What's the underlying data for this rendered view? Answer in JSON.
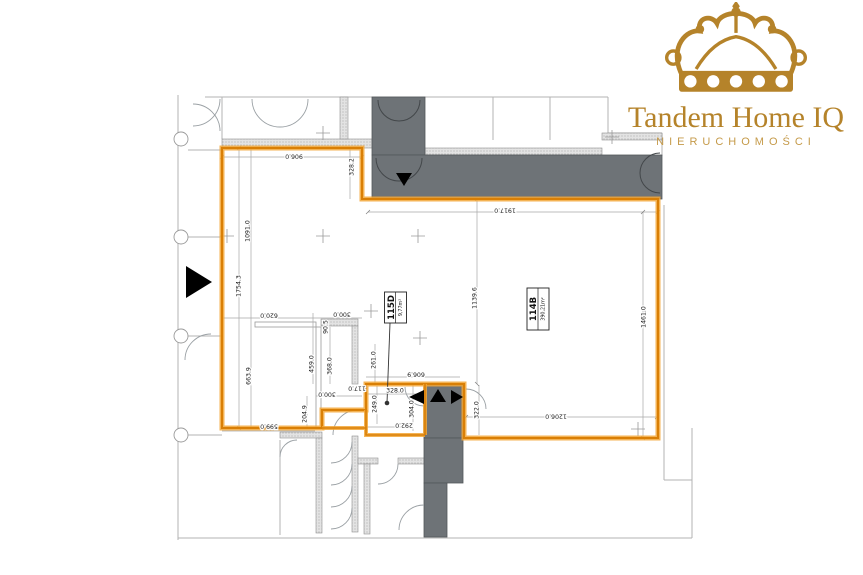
{
  "brand": {
    "name": "Tandem Home IQ",
    "subtitle": "NIERUCHOMOŚCI",
    "gold": "#b5832a"
  },
  "plan": {
    "units": [
      {
        "id": "115D",
        "area": "9,77m²"
      },
      {
        "id": "114B",
        "area": "390,21m²"
      }
    ],
    "dimensions": [
      "906.0",
      "328.2",
      "1917.0",
      "1091.0",
      "1754.3",
      "620.0",
      "663.9",
      "599.0",
      "204.9",
      "300.0",
      "90.5",
      "459.0",
      "368.0",
      "261.0",
      "117.0",
      "328.0",
      "249.0",
      "304.0",
      "292.0",
      "606.9",
      "300.0",
      "1139.6",
      "1461.0",
      "322.0",
      "1206.0"
    ],
    "colors": {
      "unit_boundary": "#e8940f",
      "common_area_fill": "#6e7377",
      "wall_hatch": "#e3e3e3"
    }
  }
}
